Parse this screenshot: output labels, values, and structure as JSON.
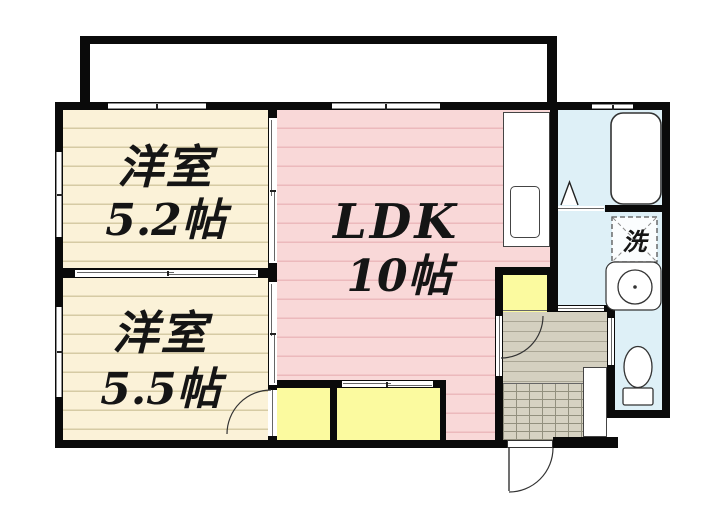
{
  "floorplan": {
    "rooms": {
      "western1": {
        "label": "洋室",
        "area": "5.2帖"
      },
      "western2": {
        "label": "洋室",
        "area": "5.5帖"
      },
      "ldk": {
        "label": "LDK",
        "area": "10帖"
      },
      "laundry": {
        "label": "洗"
      }
    },
    "fixtures": [
      "balcony",
      "bathtub",
      "washing-machine",
      "washbasin",
      "toilet",
      "kitchen-counter",
      "kitchen-sink",
      "shoe-cabinet",
      "closet",
      "hallway",
      "entrance"
    ],
    "colors": {
      "western_room": "#fbf2d8",
      "ldk": "#f9d8d8",
      "wet_area": "#def0f7",
      "closet": "#fbfa9f",
      "hallway": "#d4d0c0",
      "entrance_tile": "#d6d2c2",
      "wall": "#0a0a0a"
    }
  }
}
